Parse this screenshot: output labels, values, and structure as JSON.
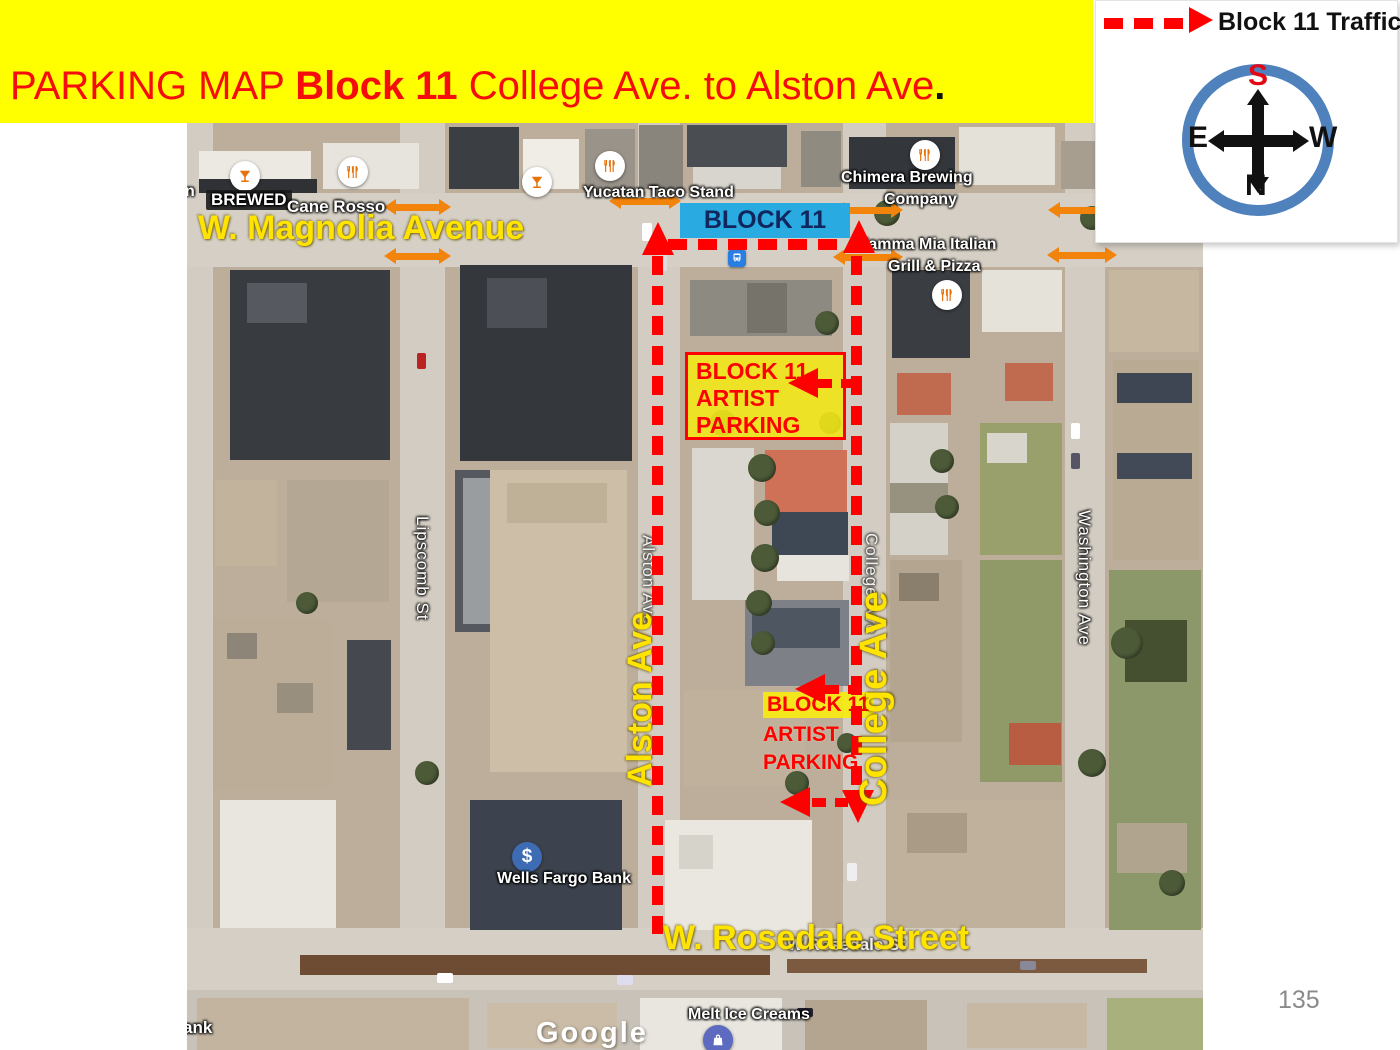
{
  "banner": {
    "title_prefix": "PARKING MAP ",
    "title_bold": "Block 11",
    "title_suffix": " College Ave. to Alston Ave",
    "title_period": "."
  },
  "legend": {
    "label": "Block 11 Traffic"
  },
  "compass": {
    "top": "S",
    "left": "E",
    "right": "W",
    "bottom": "N"
  },
  "page_number": "135",
  "map": {
    "block_label": "BLOCK 11",
    "streets": {
      "magnolia": "W. Magnolia Avenue",
      "rosedale": "W. Rosedale Street",
      "alston": "Alston Ave",
      "college": "College Ave",
      "lipscomb": "Lipscomb St",
      "washington": "Washington Ave",
      "alston_small": "Alston Ave",
      "college_small": "College Ave",
      "rosedale_small": "W Rosedale St"
    },
    "pois": {
      "brewed": "BREWED",
      "cane_rosso": "Cane Rosso",
      "yucatan": "Yucatan Taco Stand",
      "chimera_line1": "Chimera Brewing",
      "chimera_line2": "Company",
      "mamma_line1": "Mamma Mia Italian",
      "mamma_line2": "Grill & Pizza",
      "wells_fargo": "Wells Fargo Bank",
      "melt": "Melt Ice Creams",
      "bank_cut": "ank",
      "n_cut": "n",
      "dollar_glyph": "$"
    },
    "parking_upper": {
      "line1": "BLOCK 11",
      "line2": "ARTIST",
      "line3": "PARKING"
    },
    "parking_lower": {
      "line1": "BLOCK 11",
      "line2": "ARTIST",
      "line3": "PARKING"
    },
    "watermark": "Google"
  },
  "colors": {
    "banner_bg": "#FFFF00",
    "title_red": "#F50D0D",
    "route_red": "#FF0000",
    "arrow_orange": "#F2830B",
    "block_blue": "#29ABE2",
    "street_yellow": "#FFE400",
    "compass_ring": "#4F81BD"
  }
}
